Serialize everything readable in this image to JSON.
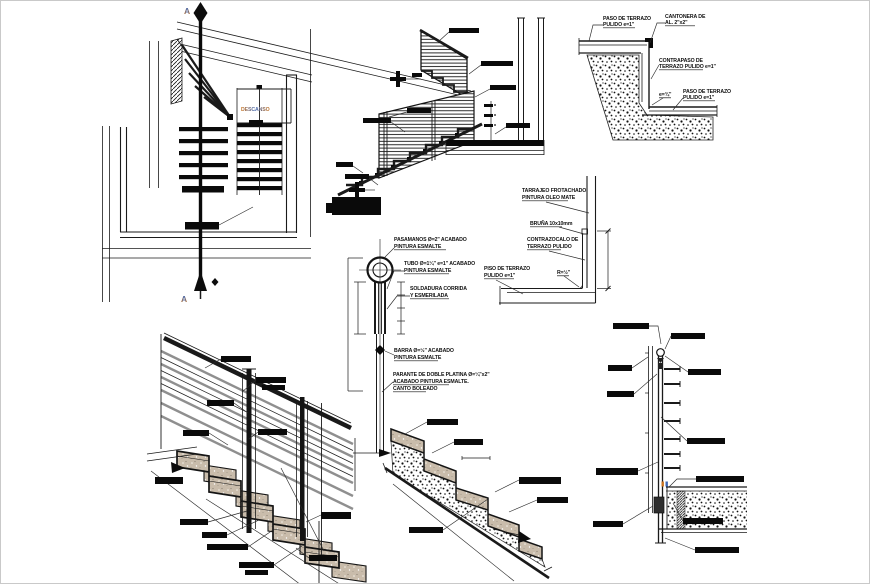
{
  "colors": {
    "ink": "#1a1a1a",
    "tan_fill": "#c9bcab",
    "rail_gray": "#8f8f8f",
    "cad_blue": "#3f68b5",
    "cad_orange": "#c9731f"
  },
  "plan": {
    "section_top": "A",
    "section_bottom": "A",
    "landing": "DESCANSO"
  },
  "step_edge": {
    "paso_sup_1": "PASO DE TERRAZO",
    "paso_sup_2": "PULIDO e=1\"",
    "cantonera_1": "CANTONERA DE",
    "cantonera_2": "AL. 2\"x2\"",
    "contrapaso_1": "CONTRAPASO DE",
    "contrapaso_2": "TERRAZO PULIDO e=1\"",
    "espesor": "e=¾\"",
    "paso_inf_1": "PASO DE TERRAZO",
    "paso_inf_2": "PULIDO e=1\""
  },
  "muro_piso": {
    "tarrajeo_1": "TARRAJEO FROTACHADO",
    "tarrajeo_2": "PINTURA OLEO MATE",
    "bruna": "BRUÑA 10x10mm",
    "contrazocalo_1": "CONTRAZOCALO DE",
    "contrazocalo_2": "TERRAZO PULIDO",
    "piso_1": "PISO DE TERRAZO",
    "piso_2": "PULIDO e=1\"",
    "radio": "R=½\""
  },
  "poste": {
    "pasamanos_1": "PASAMANOS Ø=2\" ACABADO",
    "pasamanos_2": "PINTURA ESMALTE",
    "tubo_1": "TUBO Ø=1¼\" e=1\" ACABADO",
    "tubo_2": "PINTURA ESMALTE",
    "soldadura_1": "SOLDADURA CORRIDA",
    "soldadura_2": "Y ESMERILADA",
    "barra_1": "BARRA Ø=½\" ACABADO",
    "barra_2": "PINTURA ESMALTE",
    "parante_1": "PARANTE DE DOBLE PLATINA Ø=¼\"x2\"",
    "parante_2": "ACABADO PINTURA ESMALTE.",
    "parante_3": "CANTO BOLEADO"
  }
}
